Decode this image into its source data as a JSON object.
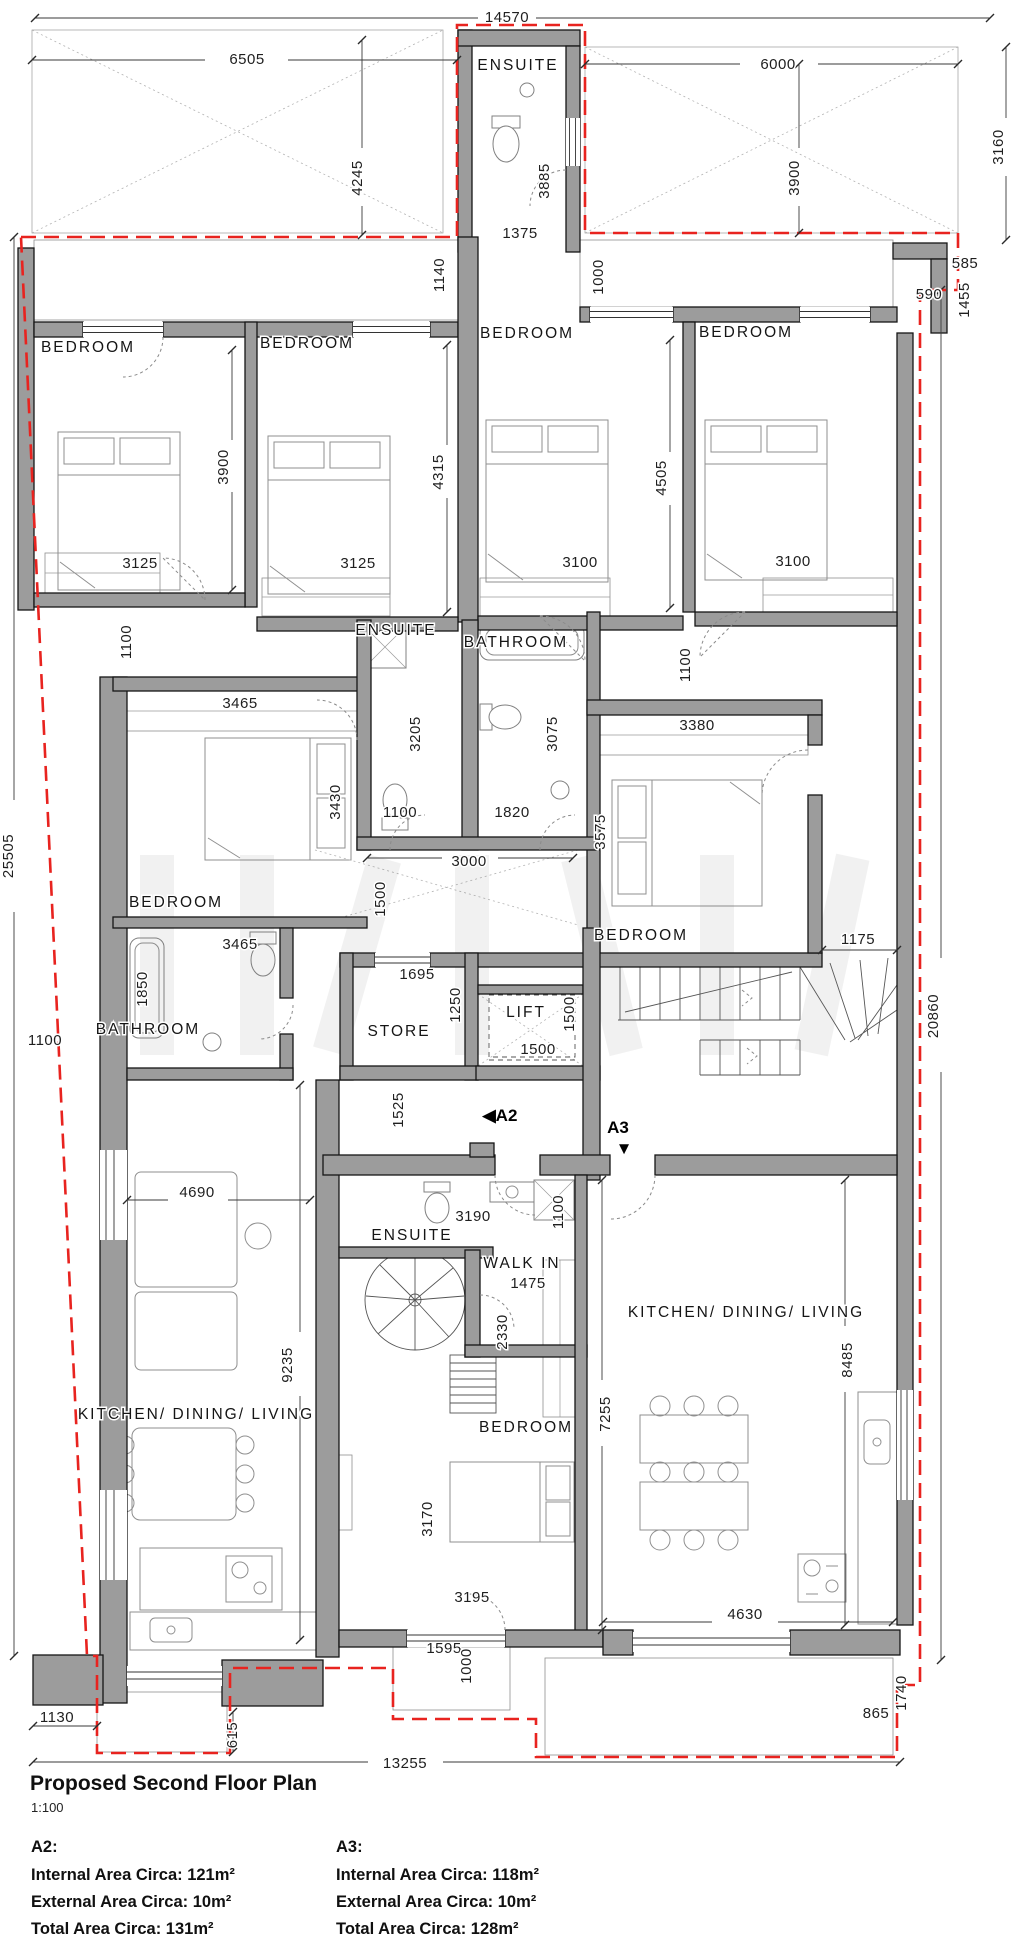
{
  "page": {
    "background": "#ffffff"
  },
  "title_block": {
    "title": "Proposed Second Floor Plan",
    "scale": "1:100"
  },
  "apartments": [
    {
      "id": "A2:",
      "internal": "Internal Area Circa: 121m²",
      "external": "External Area Circa: 10m²",
      "total": "Total Area Circa: 131m²"
    },
    {
      "id": "A3:",
      "internal": "Internal Area Circa: 118m²",
      "external": "External Area Circa: 10m²",
      "total": "Total Area Circa: 128m²"
    }
  ],
  "plan": {
    "colors": {
      "wall": "#9c9c9c",
      "line": "#1c1c1c",
      "boundary": "#e8231f",
      "hatch": "#c4c4c4"
    },
    "unit_markers": [
      {
        "label": "A2",
        "icon": "left-triangle",
        "x": 500,
        "y": 1121
      },
      {
        "label": "A3",
        "icon": "down-triangle",
        "x": 618,
        "y": 1133
      }
    ],
    "room_labels": [
      {
        "text": "ENSUITE",
        "x": 518,
        "y": 70
      },
      {
        "text": "BEDROOM",
        "x": 88,
        "y": 352
      },
      {
        "text": "BEDROOM",
        "x": 307,
        "y": 348
      },
      {
        "text": "BEDROOM",
        "x": 527,
        "y": 338
      },
      {
        "text": "BEDROOM",
        "x": 746,
        "y": 337
      },
      {
        "text": "ENSUITE",
        "x": 396,
        "y": 635
      },
      {
        "text": "BATHROOM",
        "x": 516,
        "y": 647
      },
      {
        "text": "BEDROOM",
        "x": 176,
        "y": 907
      },
      {
        "text": "BEDROOM",
        "x": 641,
        "y": 940
      },
      {
        "text": "BATHROOM",
        "x": 148,
        "y": 1034
      },
      {
        "text": "STORE",
        "x": 399,
        "y": 1036
      },
      {
        "text": "LIFT",
        "x": 526,
        "y": 1017
      },
      {
        "text": "ENSUITE",
        "x": 412,
        "y": 1240
      },
      {
        "text": "WALK IN",
        "x": 522,
        "y": 1268
      },
      {
        "text": "BEDROOM",
        "x": 526,
        "y": 1432
      },
      {
        "text": "KITCHEN/ DINING/ LIVING",
        "x": 196,
        "y": 1419
      },
      {
        "text": "KITCHEN/ DINING/ LIVING",
        "x": 746,
        "y": 1317
      }
    ],
    "dimensions": [
      {
        "text": "14570",
        "x": 507,
        "y": 22
      },
      {
        "text": "6505",
        "x": 247,
        "y": 64
      },
      {
        "text": "6000",
        "x": 778,
        "y": 69
      },
      {
        "text": "3160",
        "x": 1003,
        "y": 147,
        "r": -90
      },
      {
        "text": "4245",
        "x": 362,
        "y": 178,
        "r": -90
      },
      {
        "text": "3885",
        "x": 549,
        "y": 181,
        "r": -90
      },
      {
        "text": "3900",
        "x": 799,
        "y": 178,
        "r": -90
      },
      {
        "text": "1375",
        "x": 520,
        "y": 238
      },
      {
        "text": "1140",
        "x": 444,
        "y": 275,
        "r": -90
      },
      {
        "text": "1000",
        "x": 603,
        "y": 277,
        "r": -90
      },
      {
        "text": "585",
        "x": 965,
        "y": 268
      },
      {
        "text": "1455",
        "x": 969,
        "y": 300,
        "r": -90
      },
      {
        "text": "590",
        "x": 929,
        "y": 299
      },
      {
        "text": "3900",
        "x": 228,
        "y": 467,
        "r": -90
      },
      {
        "text": "4315",
        "x": 443,
        "y": 472,
        "r": -90
      },
      {
        "text": "4505",
        "x": 666,
        "y": 478,
        "r": -90
      },
      {
        "text": "3125",
        "x": 140,
        "y": 568
      },
      {
        "text": "3125",
        "x": 358,
        "y": 568
      },
      {
        "text": "3100",
        "x": 580,
        "y": 567
      },
      {
        "text": "3100",
        "x": 793,
        "y": 566
      },
      {
        "text": "1100",
        "x": 131,
        "y": 642,
        "r": -90
      },
      {
        "text": "1100",
        "x": 690,
        "y": 665,
        "r": -90
      },
      {
        "text": "3465",
        "x": 240,
        "y": 708
      },
      {
        "text": "3380",
        "x": 697,
        "y": 730
      },
      {
        "text": "3205",
        "x": 420,
        "y": 734,
        "r": -90
      },
      {
        "text": "3075",
        "x": 557,
        "y": 734,
        "r": -90
      },
      {
        "text": "3430",
        "x": 340,
        "y": 802,
        "r": -90
      },
      {
        "text": "1100",
        "x": 400,
        "y": 817
      },
      {
        "text": "1820",
        "x": 512,
        "y": 817
      },
      {
        "text": "3575",
        "x": 605,
        "y": 832,
        "r": -90
      },
      {
        "text": "3000",
        "x": 469,
        "y": 866
      },
      {
        "text": "1500",
        "x": 385,
        "y": 899,
        "r": -90
      },
      {
        "text": "25505",
        "x": 13,
        "y": 856,
        "r": -90
      },
      {
        "text": "3465",
        "x": 240,
        "y": 949
      },
      {
        "text": "1175",
        "x": 858,
        "y": 944
      },
      {
        "text": "1850",
        "x": 147,
        "y": 989,
        "r": -90
      },
      {
        "text": "1695",
        "x": 417,
        "y": 979
      },
      {
        "text": "1250",
        "x": 460,
        "y": 1005,
        "r": -90
      },
      {
        "text": "1500",
        "x": 574,
        "y": 1014,
        "r": -90
      },
      {
        "text": "1500",
        "x": 538,
        "y": 1054
      },
      {
        "text": "1100",
        "x": 45,
        "y": 1045
      },
      {
        "text": "20860",
        "x": 938,
        "y": 1016,
        "r": -90
      },
      {
        "text": "1525",
        "x": 403,
        "y": 1110,
        "r": -90
      },
      {
        "text": "3190",
        "x": 473,
        "y": 1221
      },
      {
        "text": "1100",
        "x": 563,
        "y": 1212,
        "r": -90
      },
      {
        "text": "1475",
        "x": 528,
        "y": 1288
      },
      {
        "text": "2330",
        "x": 507,
        "y": 1332,
        "r": -90
      },
      {
        "text": "4690",
        "x": 197,
        "y": 1197
      },
      {
        "text": "9235",
        "x": 292,
        "y": 1365,
        "r": -90
      },
      {
        "text": "7255",
        "x": 610,
        "y": 1414,
        "r": -90
      },
      {
        "text": "8485",
        "x": 852,
        "y": 1360,
        "r": -90
      },
      {
        "text": "3170",
        "x": 432,
        "y": 1519,
        "r": -90
      },
      {
        "text": "3195",
        "x": 472,
        "y": 1602
      },
      {
        "text": "1595",
        "x": 444,
        "y": 1653
      },
      {
        "text": "1000",
        "x": 471,
        "y": 1666,
        "r": -90
      },
      {
        "text": "4630",
        "x": 745,
        "y": 1619
      },
      {
        "text": "1130",
        "x": 57,
        "y": 1722
      },
      {
        "text": "615",
        "x": 237,
        "y": 1735,
        "r": -90
      },
      {
        "text": "13255",
        "x": 405,
        "y": 1768
      },
      {
        "text": "1740",
        "x": 906,
        "y": 1693,
        "r": -90
      },
      {
        "text": "865",
        "x": 876,
        "y": 1718
      }
    ]
  }
}
